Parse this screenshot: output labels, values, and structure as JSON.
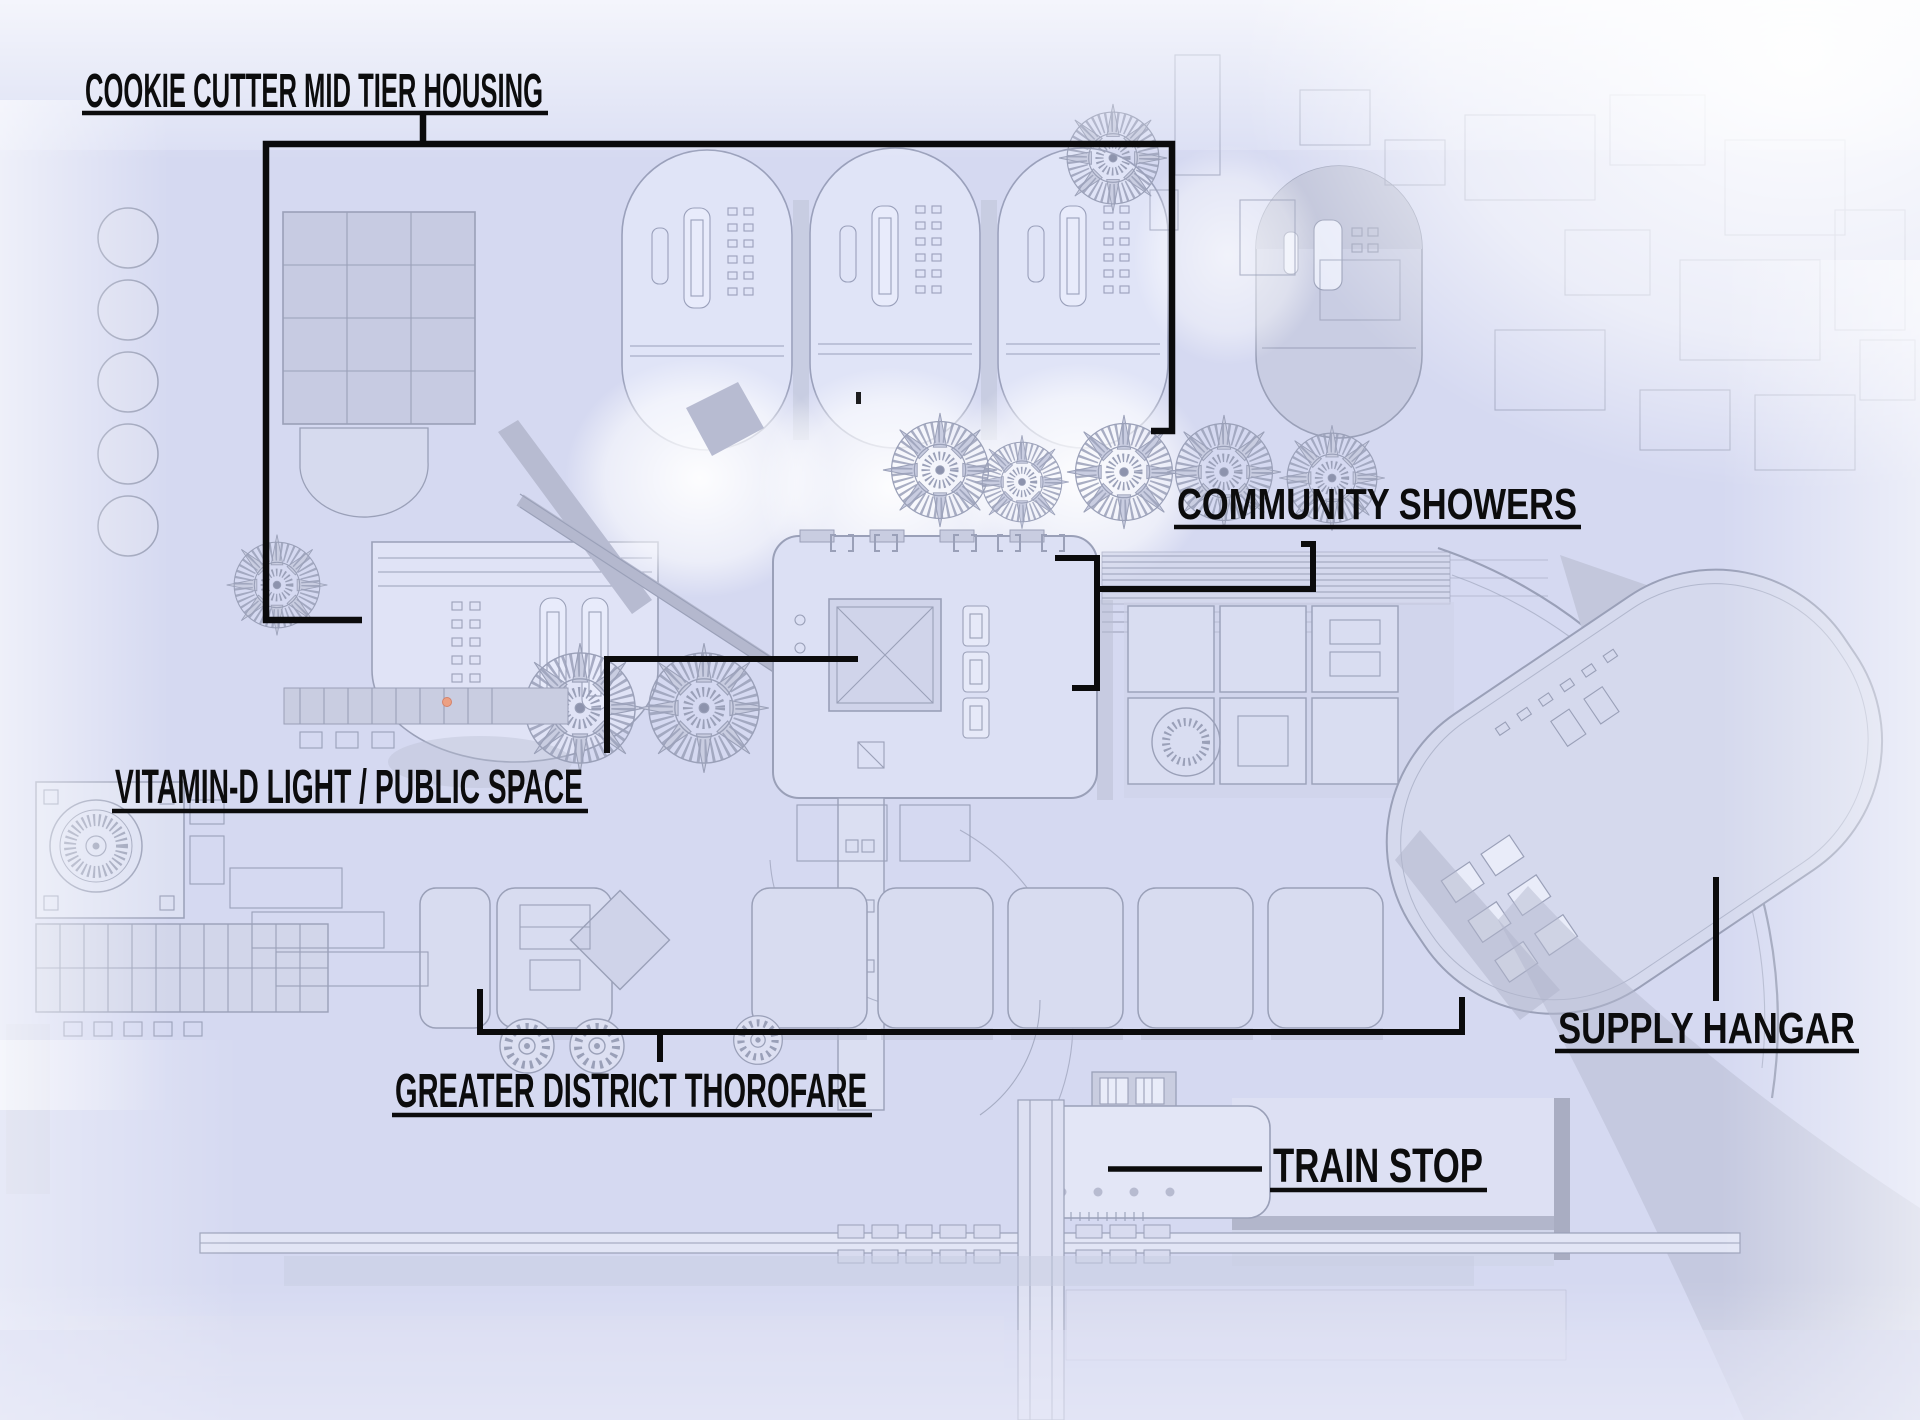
{
  "page": {
    "kind": "annotated district blueprint",
    "colors": {
      "canvas": "#d5d9f1",
      "blueprint_line": "#9aa0b8",
      "annotation_ink": "#0c0c0d",
      "highlight_dot": "#eca083"
    }
  },
  "annotations": {
    "housing": {
      "label": "COOKIE CUTTER MID TIER HOUSING"
    },
    "showers": {
      "label": "COMMUNITY SHOWERS"
    },
    "vitamin_d": {
      "label": "VITAMIN-D LIGHT / PUBLIC SPACE"
    },
    "thorofare": {
      "label": "GREATER DISTRICT THOROFARE"
    },
    "hangar": {
      "label": "SUPPLY HANGAR"
    },
    "train": {
      "label": "TRAIN STOP"
    }
  }
}
